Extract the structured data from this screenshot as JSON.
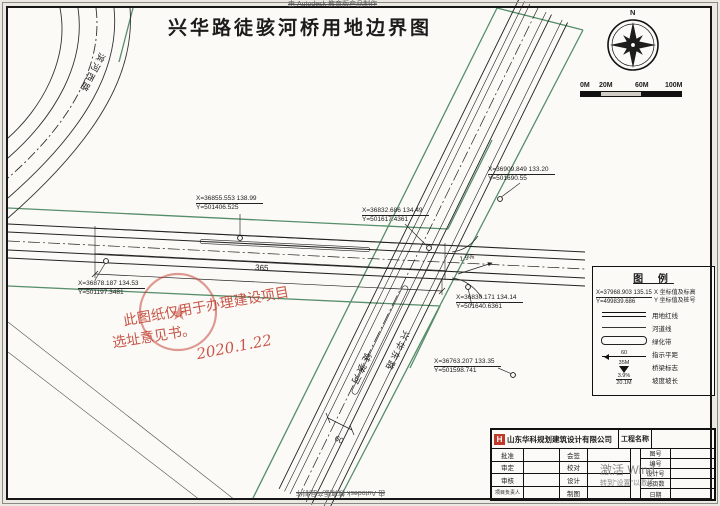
{
  "frame": {
    "autodesk_top": "由 Autodesk 教育版产品制作",
    "autodesk_bottom": "由 Autodesk 教育版产品制作"
  },
  "title": "兴华路徒骇河桥用地边界图",
  "compass": {
    "north": "N"
  },
  "scale_bar": {
    "t0": "0M",
    "t20": "20M",
    "t60": "60M",
    "t100": "100M"
  },
  "map": {
    "roads": {
      "binhe_west": "滨河西路",
      "tuhai_river": "徒骇河",
      "xinghua_east": "兴华东路"
    },
    "coords": [
      {
        "x": "X=36855.553  138.99",
        "y": "Y=501406.525"
      },
      {
        "x": "X=36832.686  134.49",
        "y": "Y=501617.4361"
      },
      {
        "x": "X=36909.849  133.20",
        "y": "Y=501690.55"
      },
      {
        "x": "X=36878.187  134.53",
        "y": "Y=501197.3481"
      },
      {
        "x": "X=36830.171  134.14",
        "y": "Y=501640.6361"
      },
      {
        "x": "X=36763.207  133.35",
        "y": "Y=501598.741"
      }
    ],
    "dims": {
      "bridge_length": "365",
      "band_width": "60",
      "slope": "1.9%"
    },
    "red_note": {
      "line1": "此图纸仅用于办理建设项目",
      "line2": "选址意见书。",
      "date": "2020.1.22"
    }
  },
  "legend": {
    "title": "图 例",
    "sample": {
      "x": "X=37968.903  135.15",
      "y": "Y=499839.686",
      "x_label": "X 坐标值及标高",
      "y_label": "Y 坐标值及桩号"
    },
    "rows": [
      {
        "label": "用地红线"
      },
      {
        "label": "河道线"
      },
      {
        "label": "绿化带"
      },
      {
        "label": "指示平距",
        "value": "60"
      },
      {
        "label": "桥梁标志",
        "value": "35M"
      },
      {
        "label": "坡度坡长",
        "value1": "3.9%",
        "value2": "20.1M"
      }
    ]
  },
  "title_block": {
    "company": "山东华科规划建筑设计有限公司",
    "logo": "H",
    "project_label": "工程名称",
    "rows": [
      {
        "l": "批准",
        "r": "会签"
      },
      {
        "l": "审定",
        "r": "校对"
      },
      {
        "l": "审核",
        "r": "设计"
      },
      {
        "l": "项目负责人",
        "r": "制图"
      }
    ],
    "doc_rows": [
      "图号",
      "编号",
      "设计号",
      "总页数",
      "日期"
    ]
  },
  "os_watermark": {
    "line1": "激活 Wind",
    "line2": "转到\"设置\"以激活。"
  }
}
